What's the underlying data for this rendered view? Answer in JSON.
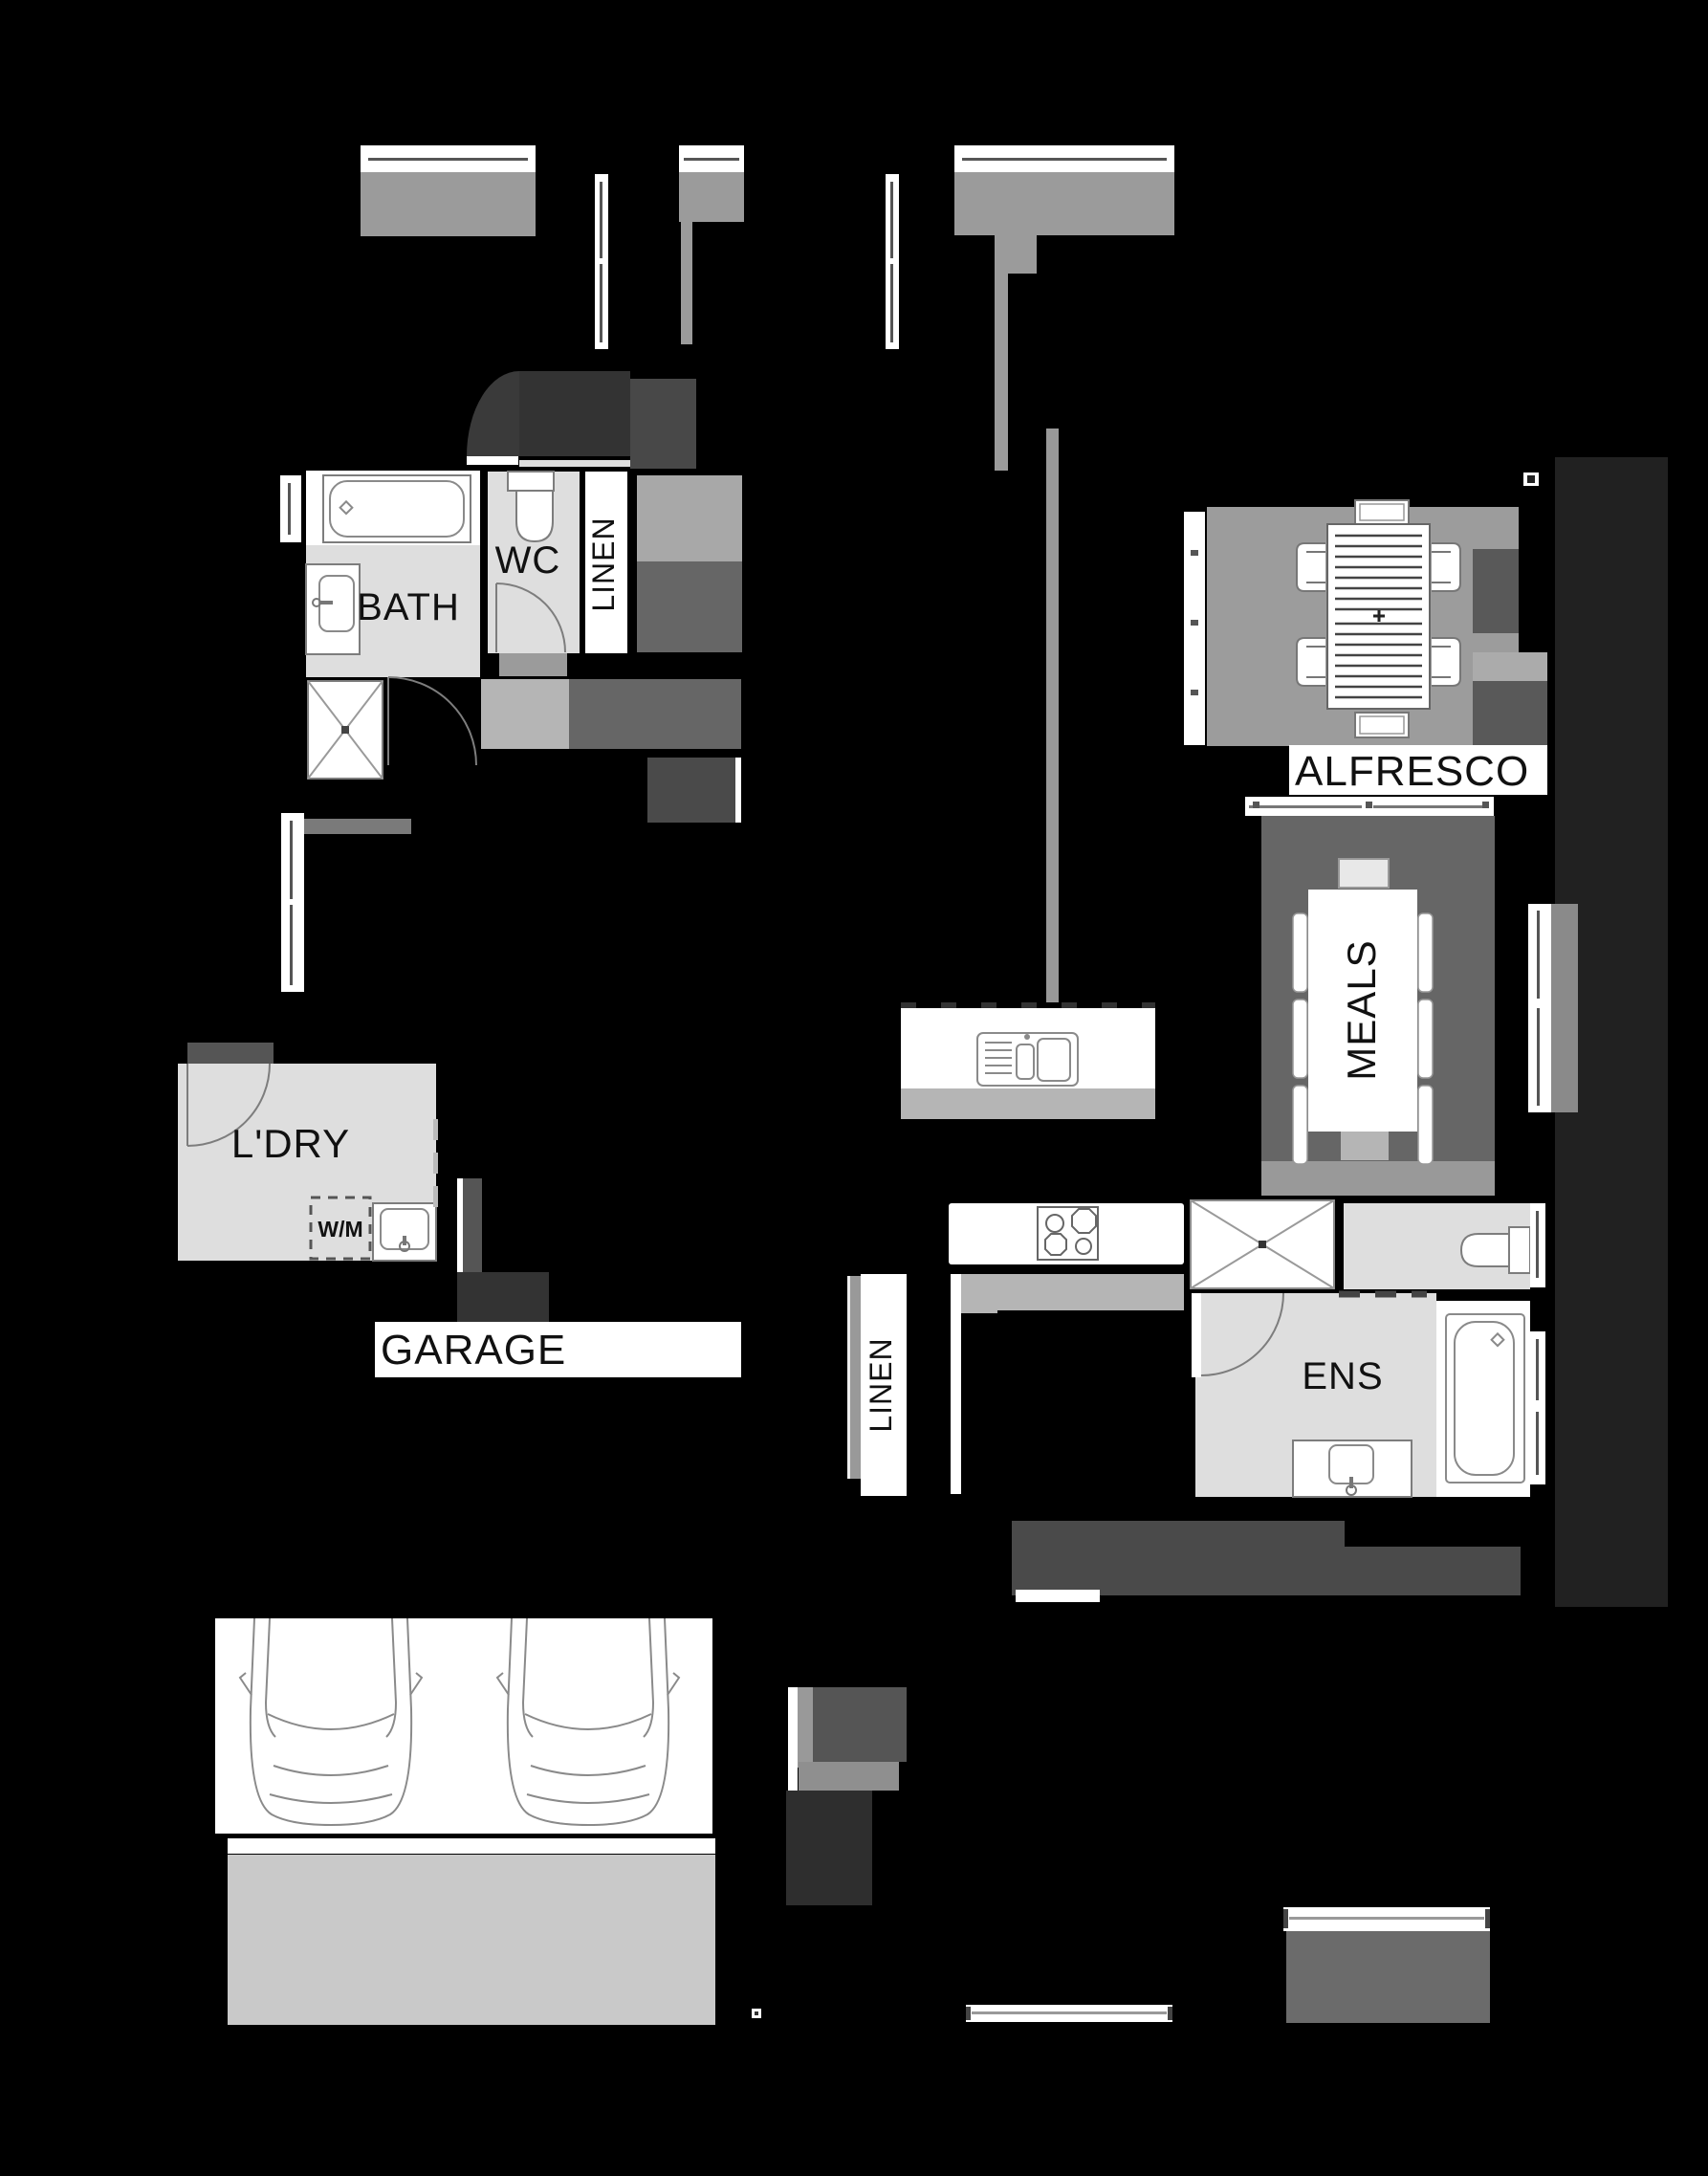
{
  "plan_title": "house floor plan (partially masked)",
  "palette": {
    "background": "#000000",
    "room_floor_light": "#dedede",
    "floor_medium": "#9c9c9c",
    "floor_dark": "#666666",
    "mask_dark": "#3a3a3a",
    "label_text": "#111111",
    "fixture_white": "#ffffff"
  },
  "labels": {
    "bath": "BATH",
    "wc": "WC",
    "linen_bath": "LINEN",
    "alfresco": "ALFRESCO",
    "meals": "MEALS",
    "laundry": "L'DRY",
    "washing_machine": "W/M",
    "garage": "GARAGE",
    "ensuite": "ENS",
    "linen_hall": "LINEN"
  }
}
